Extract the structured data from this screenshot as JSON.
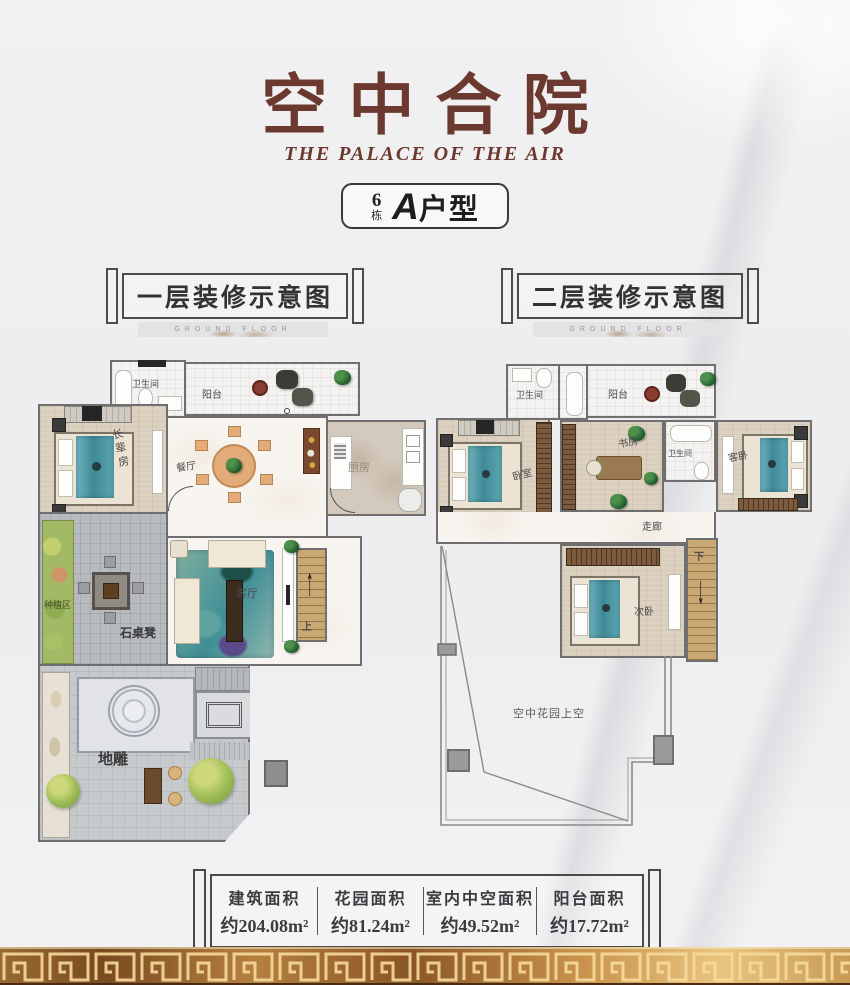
{
  "header": {
    "title": "空中合院",
    "subtitle": "THE PALACE OF THE AIR",
    "badge": {
      "number": "6",
      "unit": "栋",
      "type_letter": "A",
      "type_text": "户型"
    }
  },
  "sections": {
    "floor1": {
      "label": "一层装修示意图",
      "banner": "GROUND FLOOR"
    },
    "floor2": {
      "label": "二层装修示意图",
      "banner": "GROUND FLOOR"
    }
  },
  "plans": {
    "floor1": {
      "rooms": {
        "bathroom": "卫生间",
        "balcony": "阳台",
        "elder_bedroom": "长辈房",
        "dining": "餐厅",
        "kitchen": "厨房",
        "living": "客厅",
        "stairs_up": "上",
        "planting": "种植区",
        "stone_table": "石桌凳",
        "ground_carving": "地雕"
      }
    },
    "floor2": {
      "rooms": {
        "bathroom": "卫生间",
        "balcony": "阳台",
        "bedroom": "卧室",
        "study": "书房",
        "bathroom2": "卫生间",
        "guest_bedroom": "客卧",
        "corridor": "走廊",
        "second_bedroom": "次卧",
        "stairs_down": "下",
        "void": "空中花园上空"
      }
    }
  },
  "stats": {
    "items": [
      {
        "label": "建筑面积",
        "value": "约204.08m²"
      },
      {
        "label": "花园面积",
        "value": "约81.24m²"
      },
      {
        "label": "室内中空面积",
        "value": "约49.52m²"
      },
      {
        "label": "阳台面积",
        "value": "约17.72m²"
      }
    ]
  },
  "colors": {
    "accent": "#6B392F",
    "gold": "#C99457",
    "teal": "#4F9DAB",
    "wall": "#6F6F6F"
  }
}
